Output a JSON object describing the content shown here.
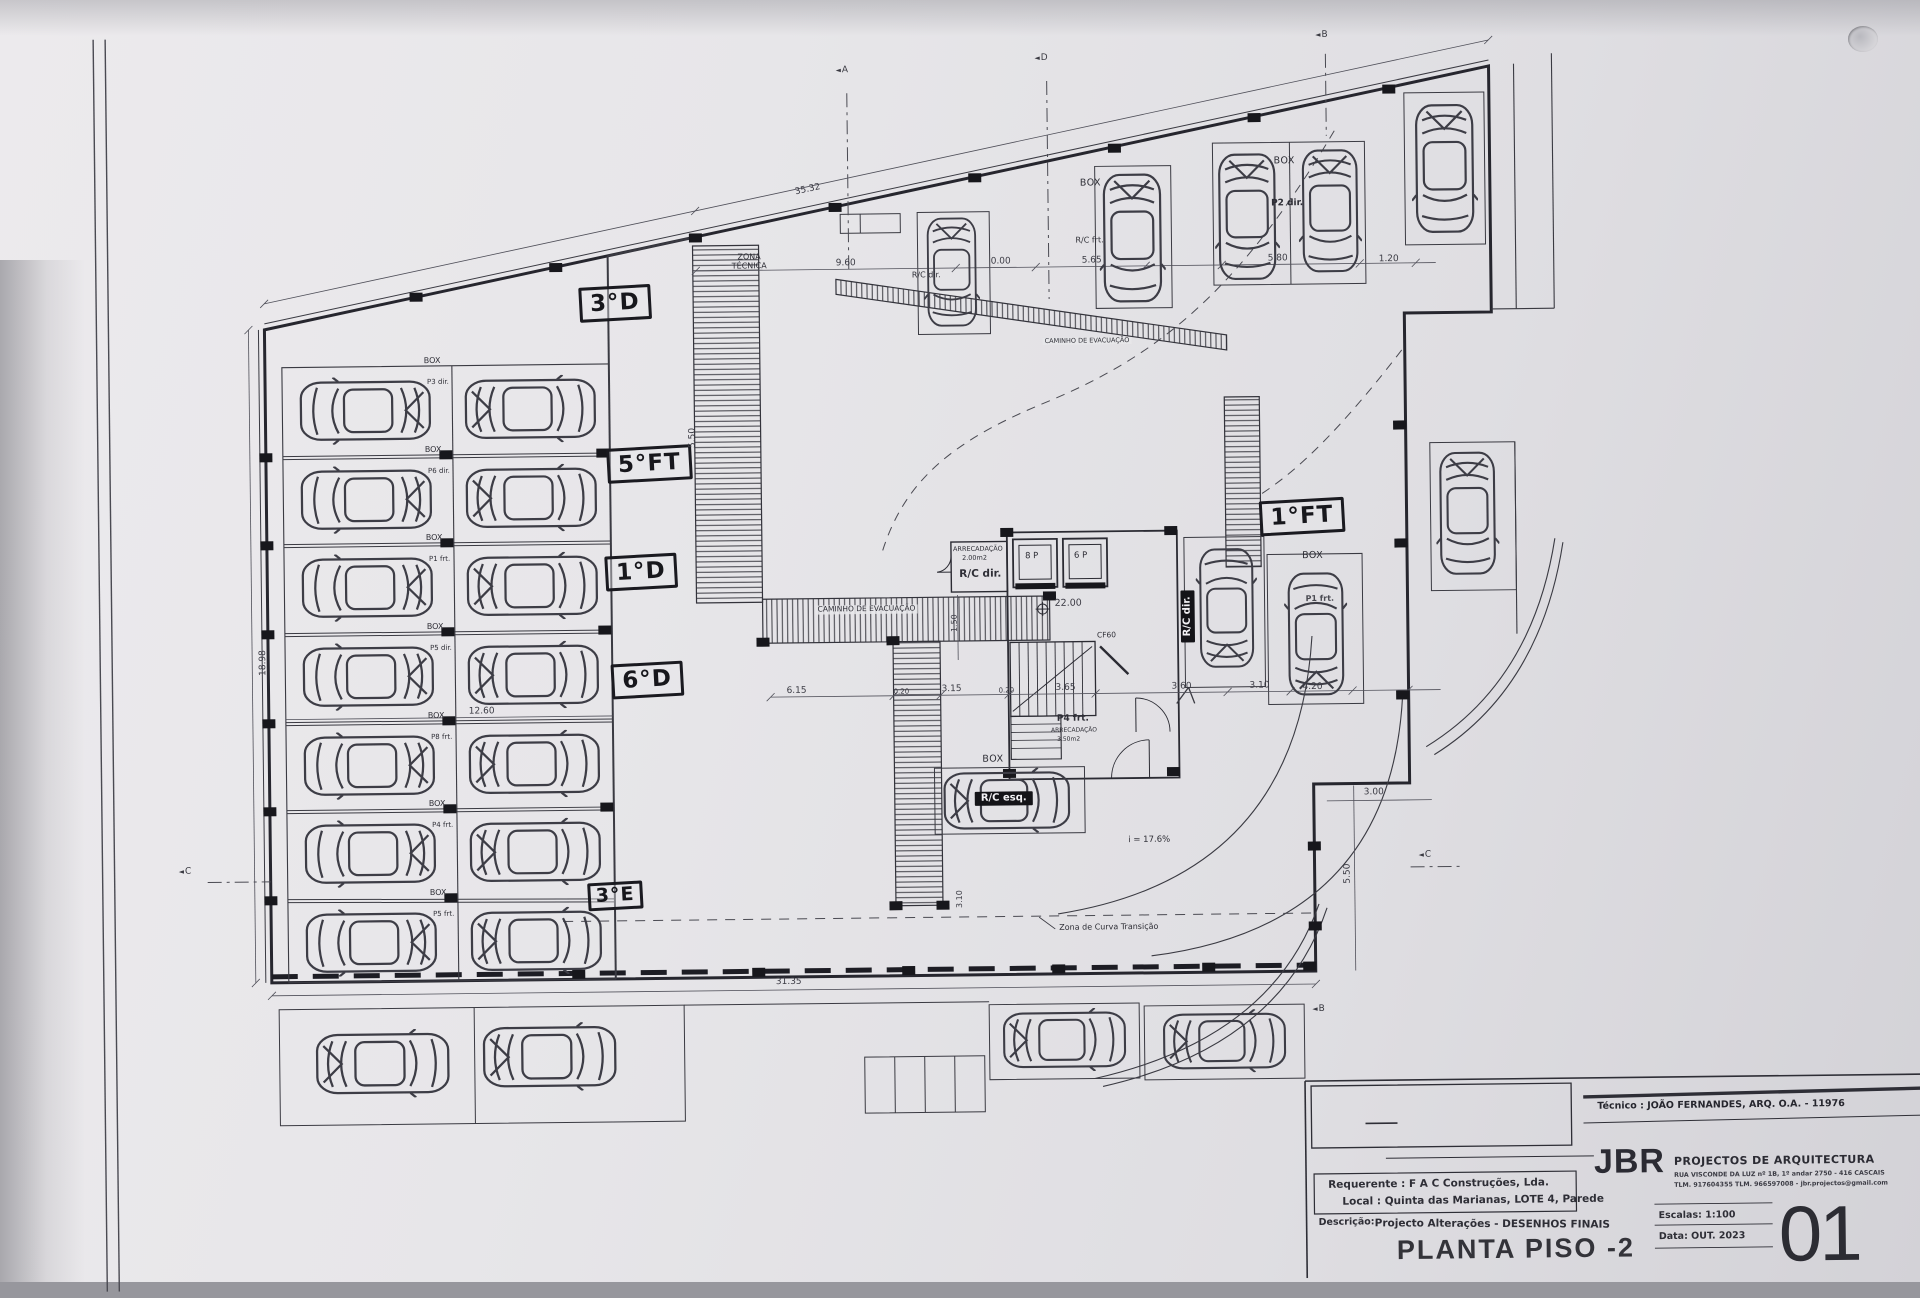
{
  "titleblock": {
    "tecnico": "Técnico : JOÃO FERNANDES, ARQ.   O.A. - 11976",
    "firm": "JBR",
    "firm_tag": "PROJECTOS DE ARQUITECTURA",
    "firm_addr1": "RUA VISCONDE DA LUZ nº 1B, 1º andar  2750 - 416  CASCAIS",
    "firm_addr2": "TLM. 917604355  TLM. 966597008 - jbr.projectos@gmail.com",
    "requerente": "Requerente : F A C  Construções, Lda.",
    "local": "Local : Quinta das Marianas, LOTE 4, Parede",
    "descricao_label": "Descrição:",
    "descricao": "Projecto Alterações - DESENHOS FINAIS",
    "plan_title": "PLANTA PISO -2",
    "escalas": "Escalas:  1:100",
    "data": "Data: OUT.  2023",
    "sheet": "01"
  },
  "handwritten": {
    "h3d": "3°D",
    "h5ft": "5°FT",
    "h1d": "1°D",
    "h6d": "6°D",
    "h3e": "3°E",
    "h1ft": "1°FT"
  },
  "labels": {
    "zona_tecnica": "ZONA\nTÉCNICA",
    "caminho1": "CAMINHO DE EVACUAÇÃO",
    "caminho2": "CAMINHO DE EVACUAÇÃO",
    "rc_dir_top": "R/C dir.",
    "box_top1": "BOX",
    "rc_frt": "R/C frt.",
    "box_top2": "BOX",
    "p2_dir": "P2 dir.",
    "arrec1_title": "ARRECADAÇÃO",
    "arrec1_area": "2.00m2",
    "arrec1_room": "R/C dir.",
    "lift_8p": "8 P",
    "lift_6p": "6 P",
    "cf60": "CF60",
    "p4_frt": "P4 frt.",
    "arrec2_title": "ARRECADAÇÃO",
    "arrec2_area": "3.50m2",
    "rc_dir_stall": "R/C dir.",
    "box_right": "BOX",
    "p1_frt": "P1 frt.",
    "box_esq": "BOX",
    "rc_esq": "R/C esq.",
    "slope": "i = 17.6%",
    "curva": "Zona de Curva Transição"
  },
  "left_rows": [
    {
      "box": "BOX",
      "stall": "P3 dir."
    },
    {
      "box": "BOX",
      "stall": "P6 dir."
    },
    {
      "box": "BOX",
      "stall": "P1 frt."
    },
    {
      "box": "BOX",
      "stall": "P5 dir."
    },
    {
      "box": "BOX",
      "stall": "P8 frt."
    },
    {
      "box": "BOX",
      "stall": "P4 frt."
    },
    {
      "box": "BOX",
      "stall": "P5 frt."
    }
  ],
  "dims": {
    "d3532": "35.32",
    "d960": "9.60",
    "d000": "0.00",
    "d565": "5.65",
    "d580": "5.80",
    "d120": "1.20",
    "d1260": "12.60",
    "d615": "6.15",
    "d020a": "0.20",
    "d315": "3.15",
    "d020b": "0.20",
    "d365": "3.65",
    "d360": "3.60",
    "d310": "3.10",
    "d420": "4.20",
    "d300": "3.00",
    "d3135": "31.35",
    "d550r": "5.50",
    "d550l": "5.50",
    "d150": "1.50",
    "d310v": "3.10",
    "d1898": "18.98",
    "level": "22.00"
  },
  "markers": {
    "a": "A",
    "d": "D",
    "b": "B",
    "c1": "C",
    "c2": "C",
    "b2": "B"
  }
}
